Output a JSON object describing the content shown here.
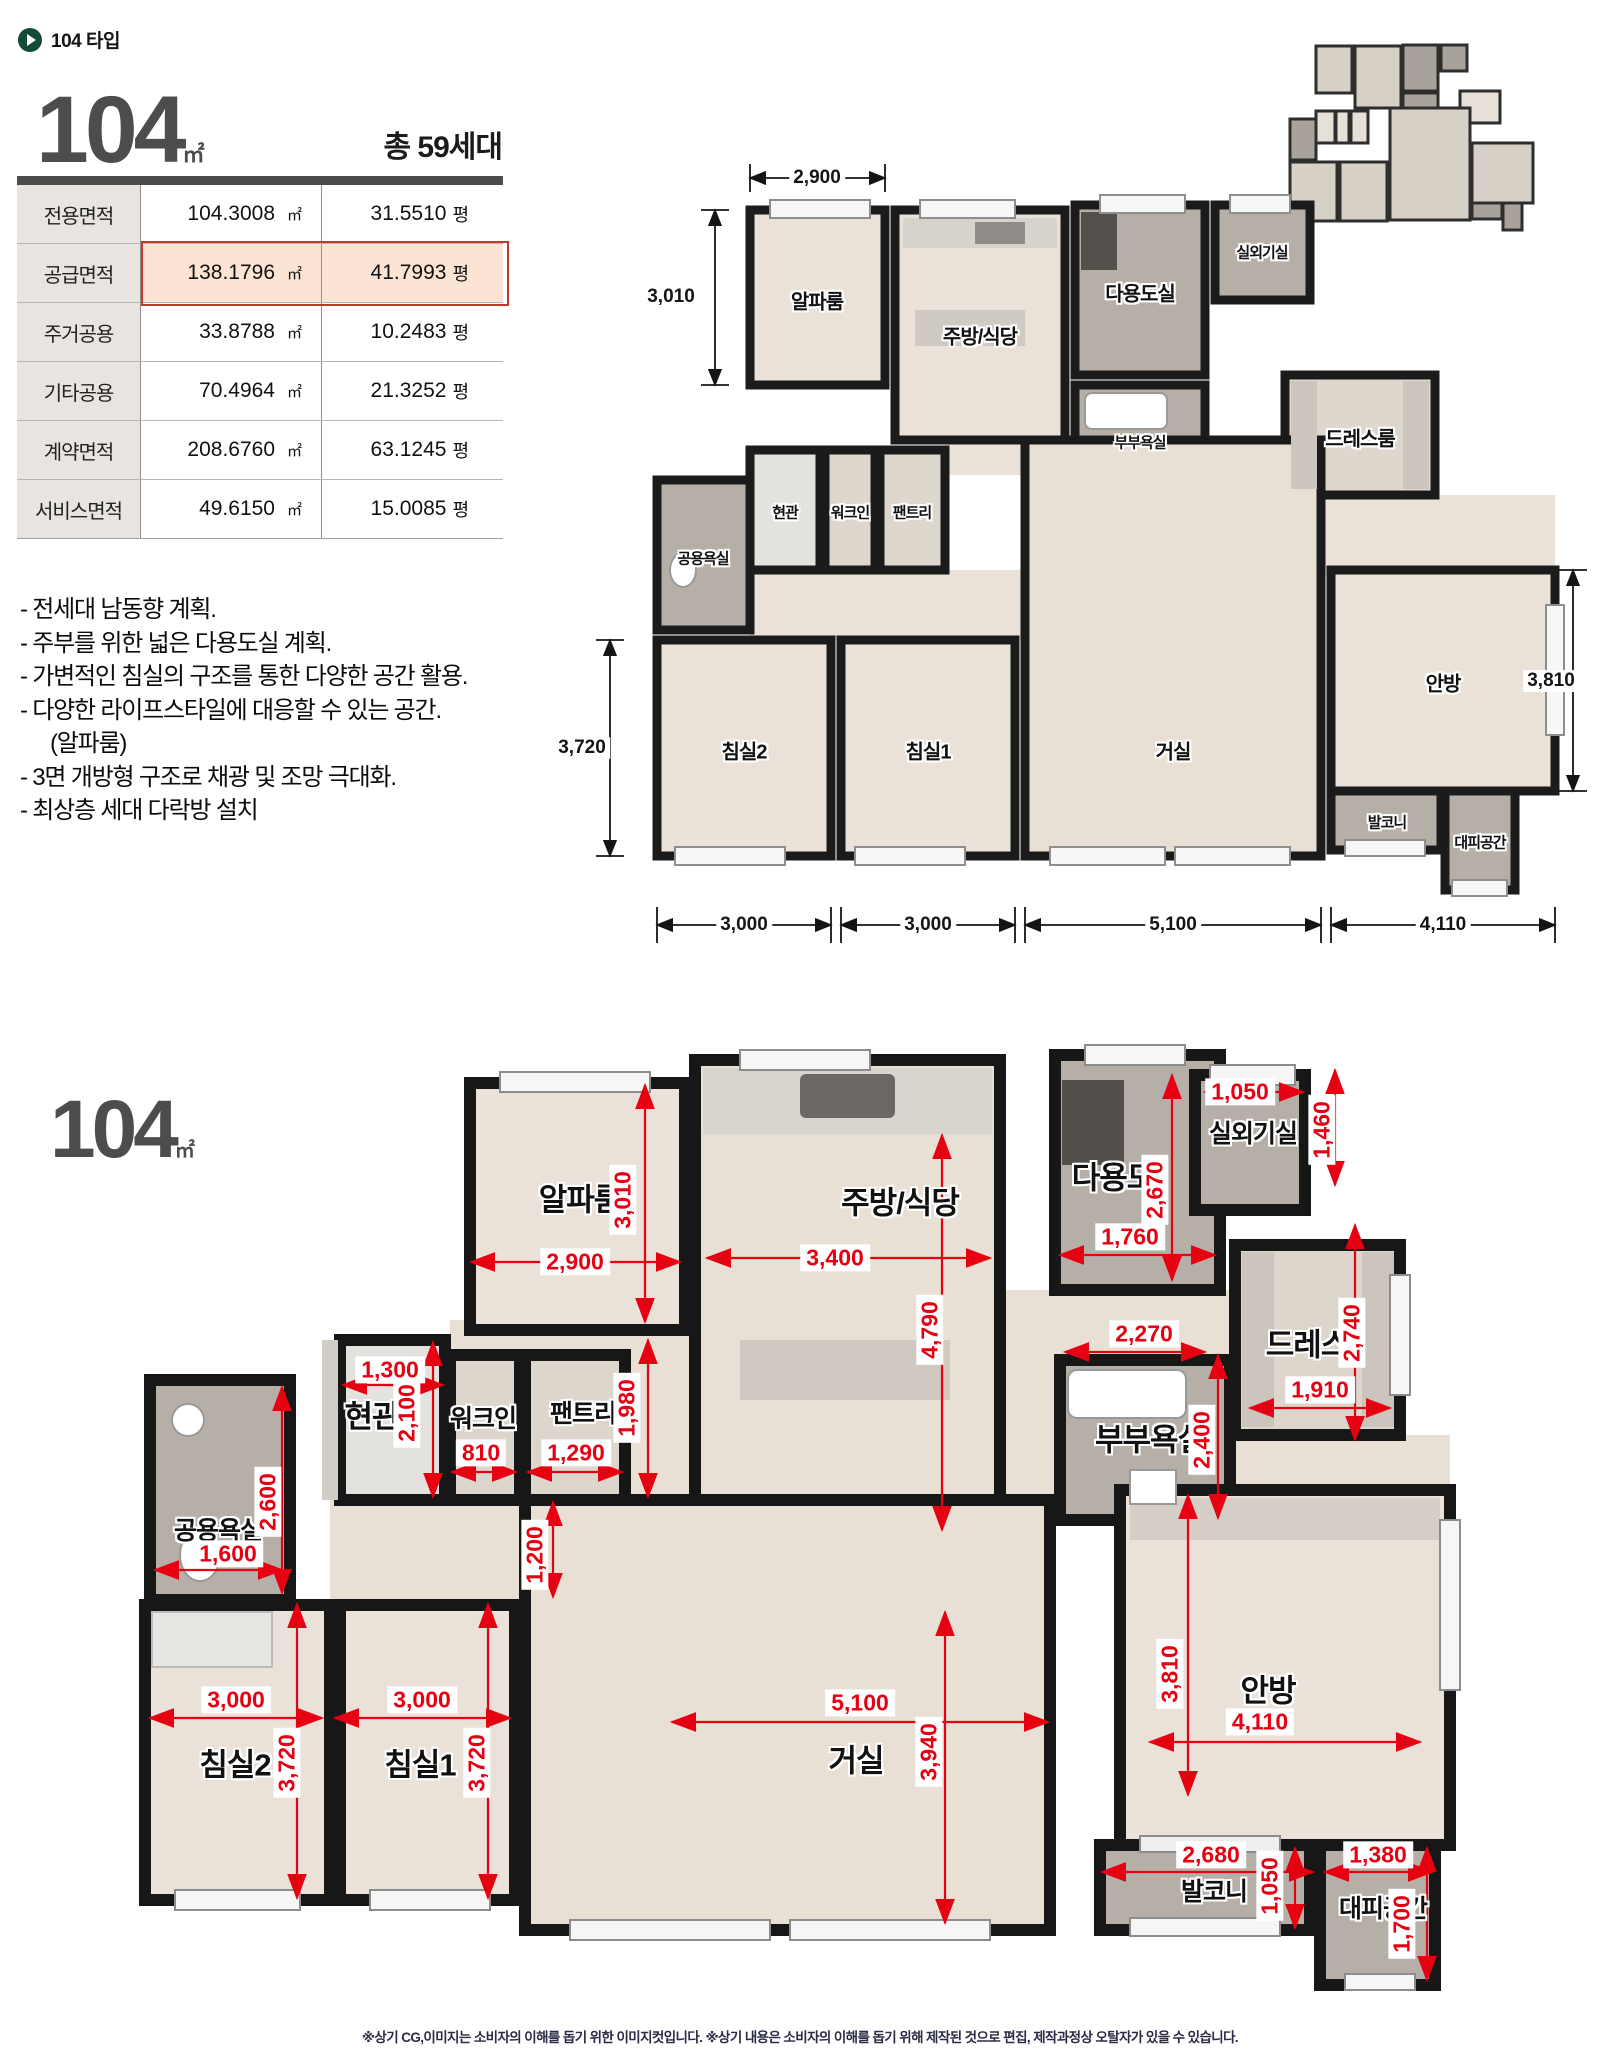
{
  "header": {
    "tag": "104 타입"
  },
  "summary": {
    "type_number": "104",
    "type_unit": "㎡",
    "total_units": "총  59세대",
    "table": {
      "rows": [
        {
          "label": "전용면적",
          "sqm": "104.3008",
          "sqm_unit": "㎡",
          "py": "31.5510",
          "py_unit": "평"
        },
        {
          "label": "공급면적",
          "sqm": "138.1796",
          "sqm_unit": "㎡",
          "py": "41.7993",
          "py_unit": "평"
        },
        {
          "label": "주거공용",
          "sqm": "33.8788",
          "sqm_unit": "㎡",
          "py": "10.2483",
          "py_unit": "평"
        },
        {
          "label": "기타공용",
          "sqm": "70.4964",
          "sqm_unit": "㎡",
          "py": "21.3252",
          "py_unit": "평"
        },
        {
          "label": "계약면적",
          "sqm": "208.6760",
          "sqm_unit": "㎡",
          "py": "63.1245",
          "py_unit": "평"
        },
        {
          "label": "서비스면적",
          "sqm": "49.6150",
          "sqm_unit": "㎡",
          "py": "15.0085",
          "py_unit": "평"
        }
      ]
    },
    "features": [
      "- 전세대 남동향 계획.",
      "- 주부를 위한 넓은 다용도실 계획.",
      "- 가변적인 침실의 구조를 통한 다양한 공간 활용.",
      "-  다양한 라이프스타일에 대응할 수 있는 공간.",
      "(알파룸)",
      "-  3면 개방형 구조로 채광 및 조망 극대화.",
      "-  최상층 세대 다락방 설치"
    ]
  },
  "plan_top": {
    "rooms": {
      "alpha": "알파룸",
      "kitchen": "주방/식당",
      "utility": "다용도실",
      "outdoor": "실외기실",
      "dress": "드레스룸",
      "master_bath": "부부욕실",
      "entrance": "현관",
      "walkin": "워크인",
      "pantry": "팬트리",
      "common_bath": "공용욕실",
      "bed2": "침실2",
      "bed1": "침실1",
      "living": "거실",
      "master": "안방",
      "balcony": "발코니",
      "refuge": "대피공간"
    },
    "dims": {
      "alpha_w": "2,900",
      "alpha_h": "3,010",
      "bed_h": "3,720",
      "master_h": "3,810",
      "b1": "3,000",
      "b2": "3,000",
      "b3": "5,100",
      "b4": "4,110"
    }
  },
  "plan_bottom": {
    "title": "104",
    "title_unit": "㎡",
    "rooms": {
      "alpha": "알파룸",
      "kitchen": "주방/식당",
      "utility": "다용도",
      "outdoor": "실외기실",
      "dress": "드레스",
      "master_bath": "부부욕실",
      "entrance": "현관",
      "walkin": "워크인",
      "pantry": "팬트리",
      "common_bath": "공용욕실",
      "bed2": "침실2",
      "bed1": "침실1",
      "living": "거실",
      "master": "안방",
      "balcony": "발코니",
      "refuge": "대피공간"
    },
    "dims": {
      "alpha_w": "2,900",
      "alpha_h": "3,010",
      "kitchen_w": "3,400",
      "kitchen_h": "4,790",
      "util_w": "1,760",
      "util_h": "2,670",
      "out_w": "1,050",
      "out_h": "1,460",
      "ent_w": "1,300",
      "ent_h": "2,100",
      "walkin_w": "810",
      "pantry_w": "1,290",
      "pantry_h": "1,980",
      "hall_h": "1,200",
      "cbath_w": "1,600",
      "cbath_h": "2,600",
      "mbath_w": "2,270",
      "mbath_h": "2,400",
      "dress_w": "1,910",
      "dress_h": "2,740",
      "bed2_w": "3,000",
      "bed2_h": "3,720",
      "bed1_w": "3,000",
      "bed1_h": "3,720",
      "living_w": "5,100",
      "living_h": "3,940",
      "master_w": "4,110",
      "master_h": "3,810",
      "balc_w": "2,680",
      "balc_h": "1,050",
      "ref_w": "1,380",
      "ref_h": "1,700"
    }
  },
  "footer": {
    "disclaimer": "※상기 CG,이미지는 소비자의 이해를 돕기 위한 이미지컷입니다. ※상기 내용은 소비자의 이해를 돕기 위해 제작된 것으로 편집, 제작과정상 오탈자가 있을 수 있습니다."
  }
}
